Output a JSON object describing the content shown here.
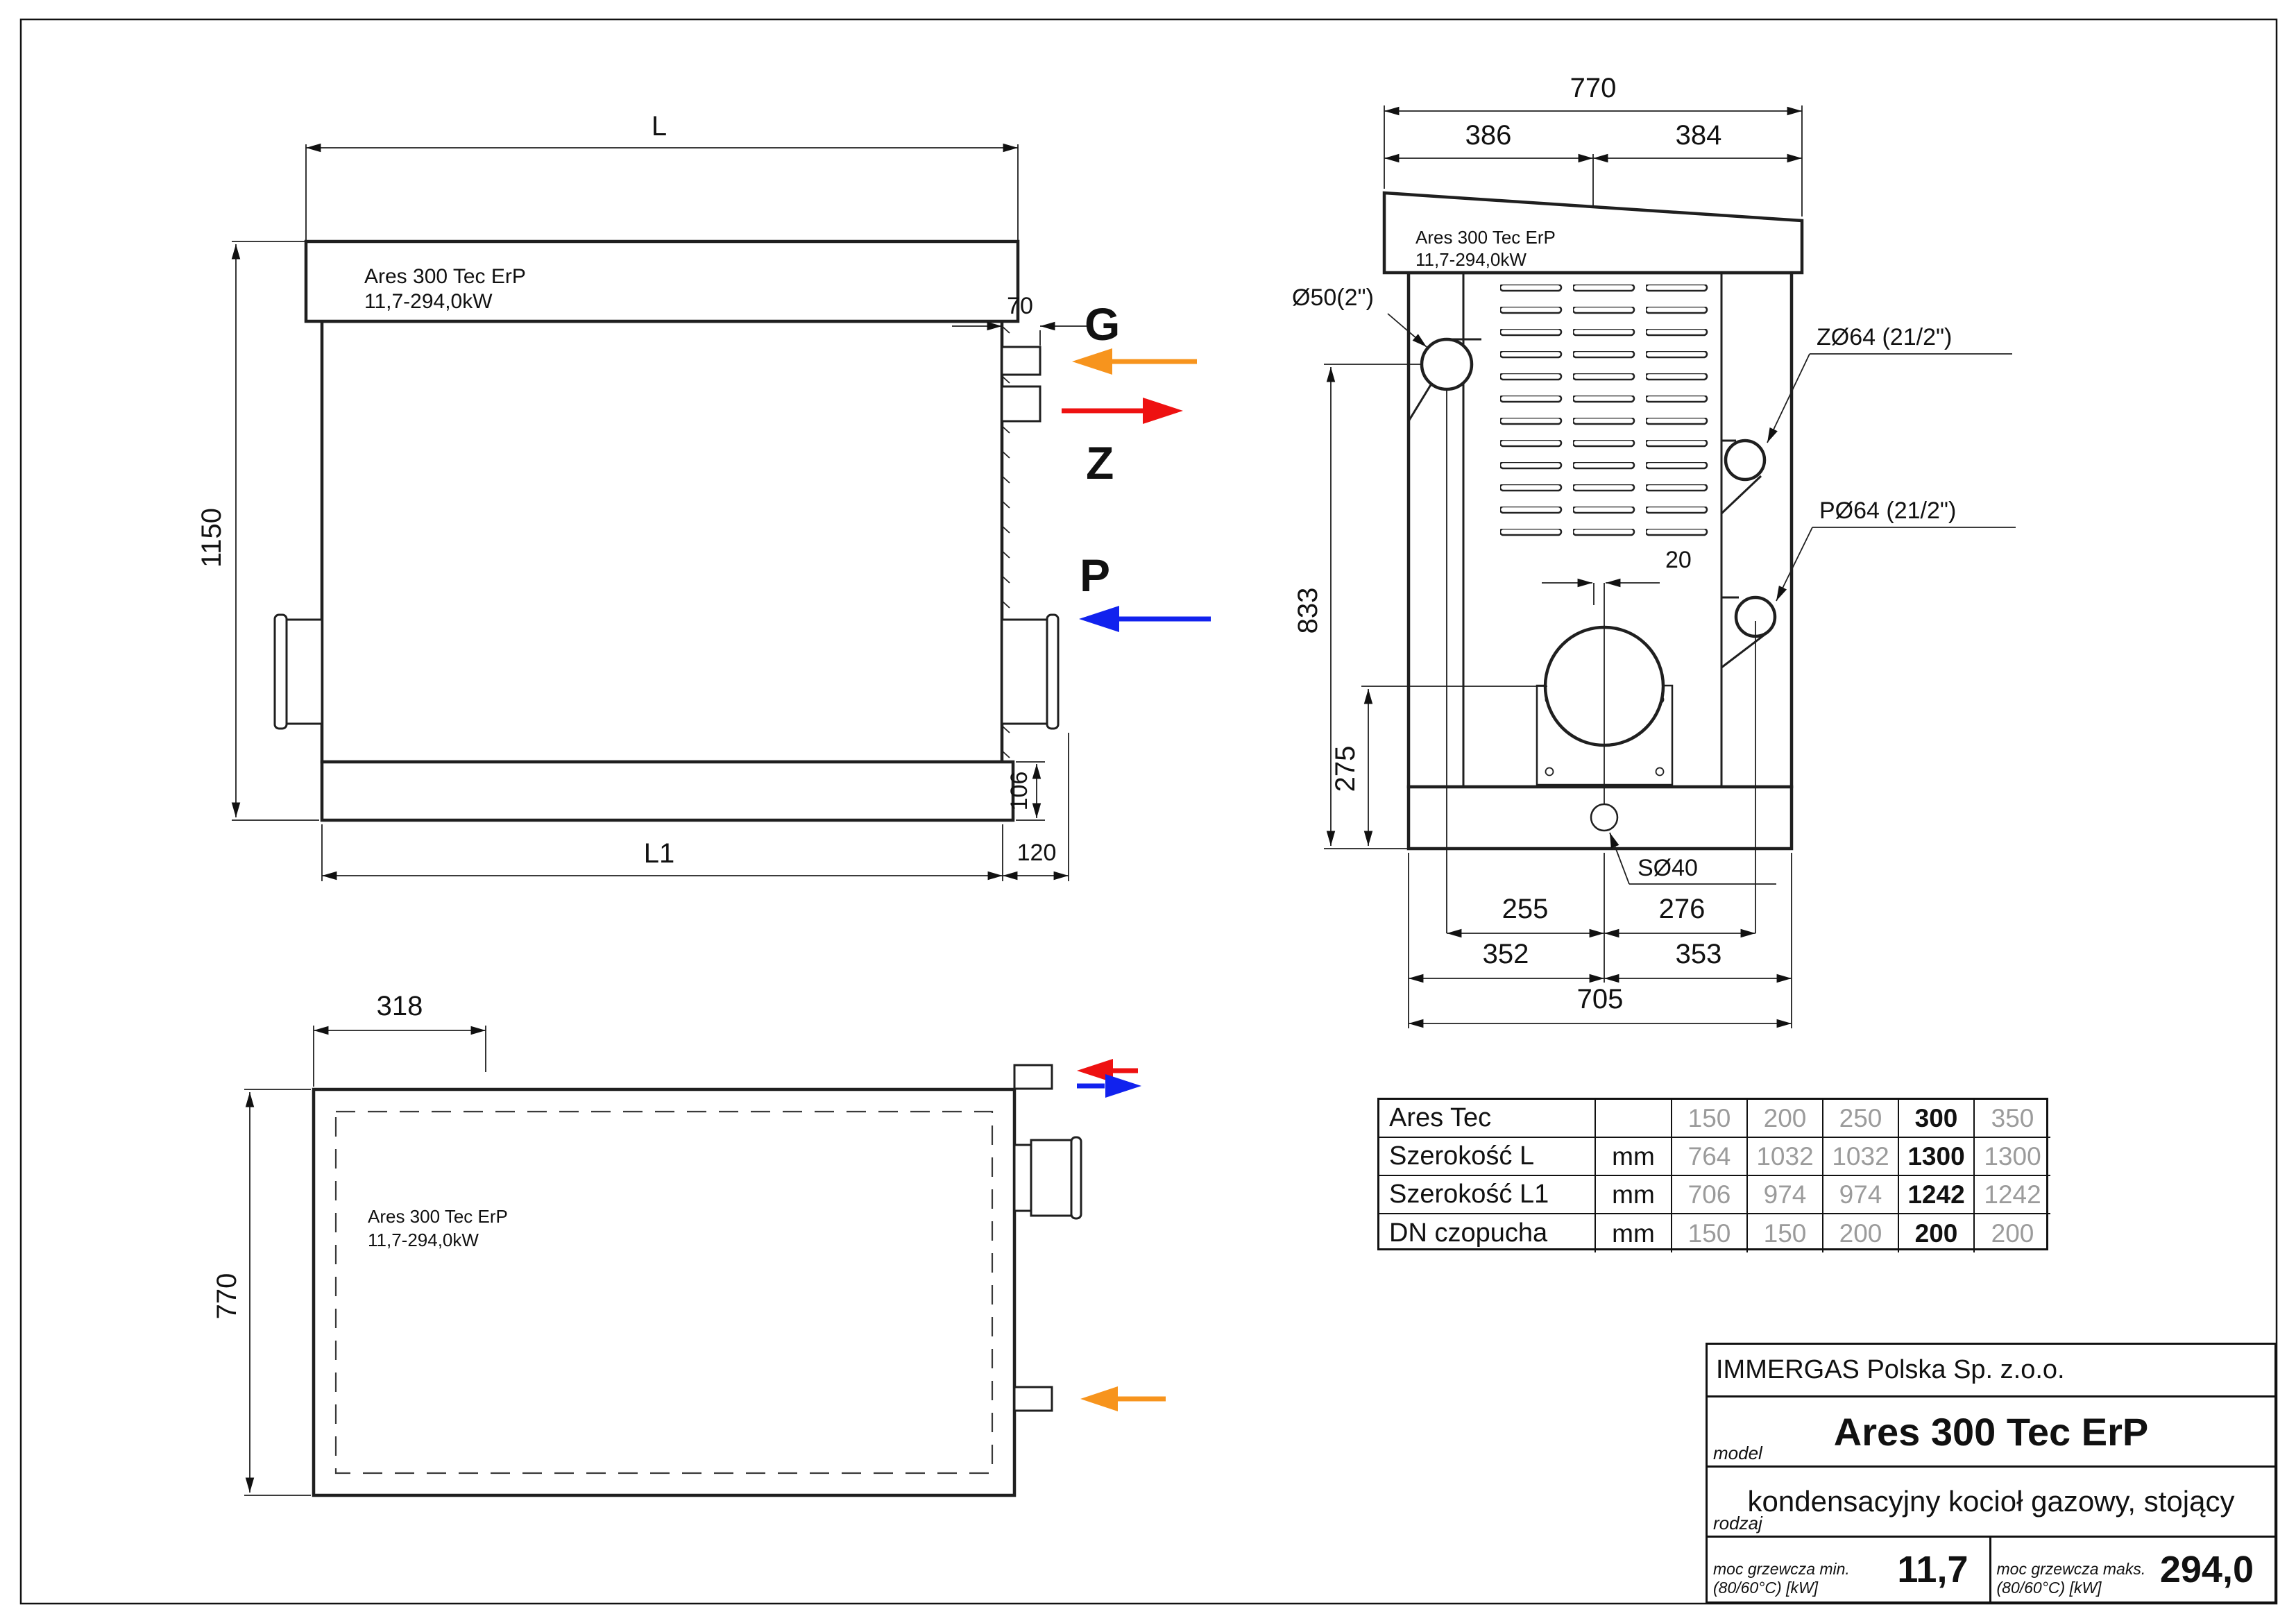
{
  "sheet": {
    "background": "#ffffff",
    "line_color": "#1f1f1f"
  },
  "colors": {
    "gas_arrow": "#f7941d",
    "heating_supply": "#ee1111",
    "heating_return": "#1122ee",
    "table_secondary": "#9b9b9b"
  },
  "boiler": {
    "name": "Ares 300 Tec ErP",
    "power_range": "11,7-294,0kW"
  },
  "front_view": {
    "dim_width_total": "L",
    "dim_height_total": "1150",
    "dim_port_depth": "70",
    "dim_base_height": "106",
    "dim_width_body": "L1",
    "dim_side_offset": "120",
    "port_gas_label": "G",
    "port_supply_label": "Z",
    "port_return_label": "P"
  },
  "side_view": {
    "dim_depth_total": "770",
    "dim_depth_left": "386",
    "dim_depth_right": "384",
    "dim_flue_offset": "20",
    "dim_gas_height": "833",
    "dim_flue_height": "275",
    "dim_gas_to_drain": "255",
    "dim_drain_to_return": "276",
    "dim_front_to_drain": "352",
    "dim_drain_to_back": "353",
    "dim_base_depth": "705",
    "label_gas_conn": "Ø50(2\")",
    "label_supply_conn": "ZØ64 (21/2\")",
    "label_return_conn": "PØ64 (21/2\")",
    "label_drain_conn": "SØ40"
  },
  "plan_view": {
    "dim_top_offset": "318",
    "dim_depth_total": "770"
  },
  "spec_table": {
    "header_label": "Ares Tec",
    "header_unit": "",
    "models": [
      "150",
      "200",
      "250",
      "300",
      "350"
    ],
    "highlighted_model": "300",
    "rows": [
      {
        "label": "Szerokość L",
        "unit": "mm",
        "values": [
          "764",
          "1032",
          "1032",
          "1300",
          "1300"
        ]
      },
      {
        "label": "Szerokość L1",
        "unit": "mm",
        "values": [
          "706",
          "974",
          "974",
          "1242",
          "1242"
        ]
      },
      {
        "label": "DN czopucha",
        "unit": "mm",
        "values": [
          "150",
          "150",
          "200",
          "200",
          "200"
        ]
      }
    ]
  },
  "title_block": {
    "company": "IMMERGAS Polska Sp. z.o.o.",
    "model_caption": "model",
    "model_name": "Ares 300 Tec ErP",
    "type_caption": "rodzaj",
    "type_value": "kondensacyjny kocioł gazowy, stojący",
    "power_min_caption_line1": "moc grzewcza min.",
    "power_min_caption_line2": "(80/60°C) [kW]",
    "power_min_value": "11,7",
    "power_max_caption_line1": "moc grzewcza maks.",
    "power_max_caption_line2": "(80/60°C) [kW]",
    "power_max_value": "294,0"
  }
}
